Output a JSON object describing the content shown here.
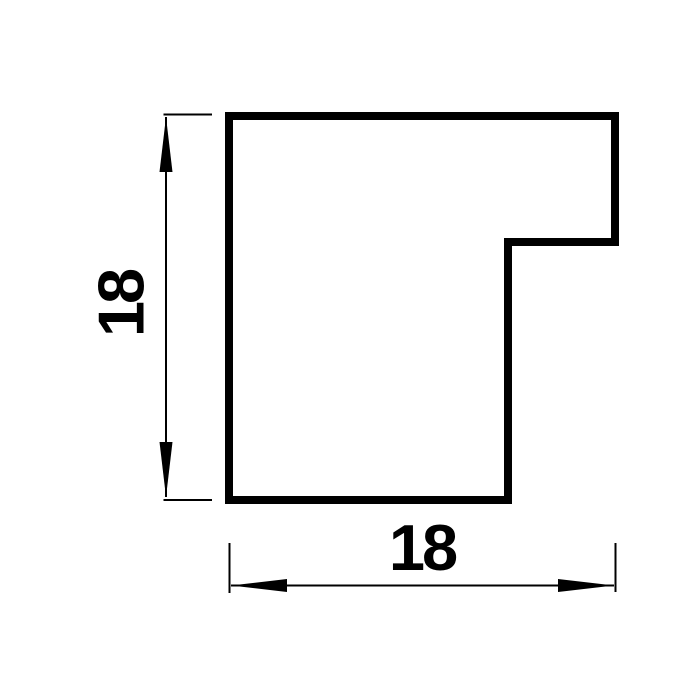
{
  "drawing": {
    "type": "technical-drawing",
    "subject": "frame-moulding-profile-cross-section",
    "background_color": "#ffffff",
    "line_color": "#000000",
    "vertical_dimension": {
      "value": "18",
      "orientation": "vertical"
    },
    "horizontal_dimension": {
      "value": "18",
      "orientation": "horizontal"
    }
  }
}
